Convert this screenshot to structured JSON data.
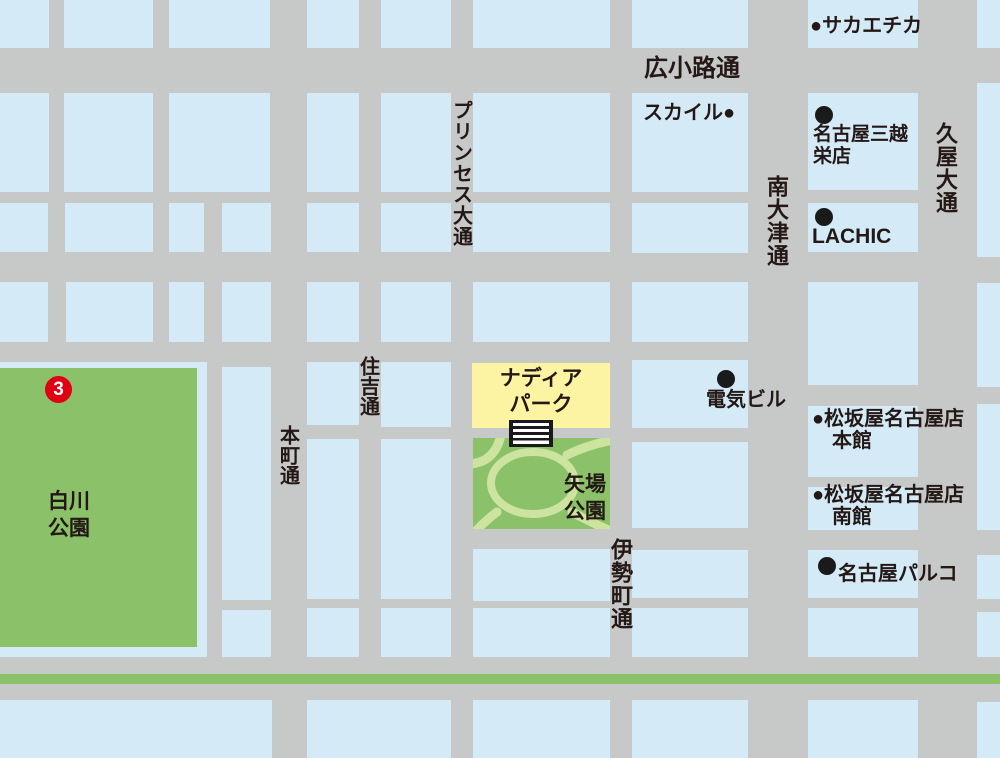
{
  "title": "栄・矢場町周辺マップ",
  "map": {
    "colors": {
      "street": "#c7c8c8",
      "city_block": "#d4eaf7",
      "park_green": "#8bc169",
      "park_path": "#cde4a1",
      "highlight_yellow": "#fcf3a3",
      "text": "#231815",
      "marker_red": "#e00012"
    },
    "marker": {
      "label": "3"
    },
    "blocks": [
      [
        0,
        0,
        49,
        48
      ],
      [
        64,
        0,
        89,
        48
      ],
      [
        169,
        0,
        101,
        48
      ],
      [
        307,
        0,
        52,
        48
      ],
      [
        381,
        0,
        70,
        48
      ],
      [
        473,
        0,
        137,
        48
      ],
      [
        632,
        0,
        116,
        48
      ],
      [
        808,
        0,
        110,
        48
      ],
      [
        977,
        0,
        23,
        48
      ],
      [
        0,
        93,
        49,
        99
      ],
      [
        64,
        93,
        89,
        99
      ],
      [
        169,
        93,
        101,
        99
      ],
      [
        307,
        93,
        52,
        99
      ],
      [
        381,
        93,
        70,
        99
      ],
      [
        473,
        93,
        137,
        99
      ],
      [
        632,
        93,
        116,
        99
      ],
      [
        808,
        93,
        110,
        97
      ],
      [
        977,
        83,
        23,
        174
      ],
      [
        0,
        203,
        48,
        49
      ],
      [
        65,
        203,
        88,
        49
      ],
      [
        169,
        203,
        35,
        49
      ],
      [
        222,
        203,
        49,
        49
      ],
      [
        307,
        203,
        52,
        49
      ],
      [
        381,
        203,
        70,
        49
      ],
      [
        473,
        203,
        137,
        49
      ],
      [
        632,
        203,
        116,
        50
      ],
      [
        808,
        203,
        110,
        49
      ],
      [
        0,
        282,
        48,
        60
      ],
      [
        66,
        282,
        87,
        60
      ],
      [
        169,
        282,
        35,
        60
      ],
      [
        222,
        282,
        49,
        60
      ],
      [
        307,
        282,
        52,
        60
      ],
      [
        381,
        282,
        70,
        60
      ],
      [
        473,
        282,
        137,
        60
      ],
      [
        632,
        282,
        116,
        60
      ],
      [
        808,
        282,
        110,
        103
      ],
      [
        977,
        283,
        23,
        104
      ],
      [
        222,
        367,
        49,
        233
      ],
      [
        307,
        362,
        52,
        63
      ],
      [
        381,
        362,
        70,
        65
      ],
      [
        632,
        360,
        116,
        68
      ],
      [
        808,
        406,
        110,
        71
      ],
      [
        977,
        404,
        23,
        126
      ],
      [
        307,
        439,
        52,
        160
      ],
      [
        381,
        439,
        70,
        160
      ],
      [
        632,
        442,
        116,
        86
      ],
      [
        808,
        487,
        110,
        43
      ],
      [
        473,
        549,
        137,
        52
      ],
      [
        632,
        550,
        116,
        48
      ],
      [
        808,
        550,
        110,
        48
      ],
      [
        977,
        555,
        23,
        44
      ],
      [
        222,
        610,
        49,
        47
      ],
      [
        307,
        608,
        52,
        49
      ],
      [
        381,
        608,
        70,
        49
      ],
      [
        473,
        608,
        137,
        49
      ],
      [
        632,
        608,
        116,
        49
      ],
      [
        808,
        608,
        110,
        49
      ],
      [
        977,
        612,
        23,
        45
      ],
      [
        0,
        700,
        272,
        58
      ],
      [
        307,
        700,
        144,
        58
      ],
      [
        473,
        700,
        137,
        58
      ],
      [
        632,
        700,
        116,
        58
      ],
      [
        808,
        700,
        110,
        58
      ],
      [
        977,
        702,
        23,
        56
      ]
    ],
    "park_underlays": [
      [
        0,
        362,
        207,
        295
      ]
    ],
    "parks": [
      [
        0,
        368,
        197,
        279
      ],
      [
        473,
        438,
        137,
        91
      ]
    ],
    "highlight_blocks": [
      [
        472,
        363,
        138,
        65
      ]
    ],
    "labels": [
      {
        "name": "street-label-hirokoji-dori",
        "text": "広小路通",
        "x": 644,
        "y": 56,
        "size": 24
      },
      {
        "name": "poi-label-sakaechika",
        "text": "●サカエチカ",
        "x": 810,
        "y": 16,
        "size": 20
      },
      {
        "name": "poi-label-skyle",
        "text": "スカイル●",
        "x": 643,
        "y": 103,
        "size": 20
      },
      {
        "name": "poi-label-mitsukoshi",
        "text": "名古屋三越\n栄店",
        "x": 813,
        "y": 124,
        "size": 19,
        "lh": 22
      },
      {
        "name": "poi-label-lachic",
        "text": "LACHIC",
        "x": 812,
        "y": 226,
        "size": 21
      },
      {
        "name": "poi-label-denki-building",
        "text": "電気ビル",
        "x": 706,
        "y": 390,
        "size": 20
      },
      {
        "name": "poi-label-nadya-park",
        "text": "ナディア\nパーク",
        "x": 472,
        "y": 366,
        "size": 21,
        "lh": 26,
        "w": 138,
        "center": true
      },
      {
        "name": "poi-label-yaba-park",
        "text": "矢場\n公園",
        "x": 564,
        "y": 471,
        "size": 21,
        "lh": 27
      },
      {
        "name": "poi-label-shirakawa-park",
        "text": "白川\n公園",
        "x": 48,
        "y": 488,
        "size": 21,
        "lh": 27
      },
      {
        "name": "poi-label-matsuzakaya-main",
        "text": "●松坂屋名古屋店\n　本館",
        "x": 812,
        "y": 408,
        "size": 20,
        "lh": 22
      },
      {
        "name": "poi-label-matsuzakaya-south",
        "text": "●松坂屋名古屋店\n　南館",
        "x": 812,
        "y": 484,
        "size": 20,
        "lh": 22
      },
      {
        "name": "poi-label-parco",
        "text": "名古屋パルコ",
        "x": 838,
        "y": 564,
        "size": 20
      }
    ],
    "vlabels": [
      {
        "name": "street-label-princess-odori",
        "text": "プリンセス大通",
        "cx": 461,
        "y": 100,
        "size": 20,
        "ls": 1
      },
      {
        "name": "street-label-sumiyoshi-dori",
        "text": "住吉通",
        "cx": 368,
        "y": 356,
        "size": 20,
        "ls": 0
      },
      {
        "name": "street-label-honmachi-dori",
        "text": "本町通",
        "cx": 288,
        "y": 425,
        "size": 20,
        "ls": 0
      },
      {
        "name": "street-label-isemachi-dori",
        "text": "伊勢町通",
        "cx": 620,
        "y": 538,
        "size": 22,
        "ls": 1
      },
      {
        "name": "street-label-minami-otsu-dori",
        "text": "南大津通",
        "cx": 776,
        "y": 175,
        "size": 22,
        "ls": 1
      },
      {
        "name": "street-label-hisaya-odori",
        "text": "久屋大通",
        "cx": 945,
        "y": 122,
        "size": 22,
        "ls": 1
      }
    ],
    "bullets": [
      {
        "name": "mitsukoshi-bullet",
        "cx": 824,
        "cy": 115
      },
      {
        "name": "lachic-bullet",
        "cx": 824,
        "cy": 217
      },
      {
        "name": "denki-building-bullet",
        "cx": 726,
        "cy": 379
      },
      {
        "name": "parco-bullet",
        "cx": 827,
        "cy": 566
      }
    ]
  }
}
